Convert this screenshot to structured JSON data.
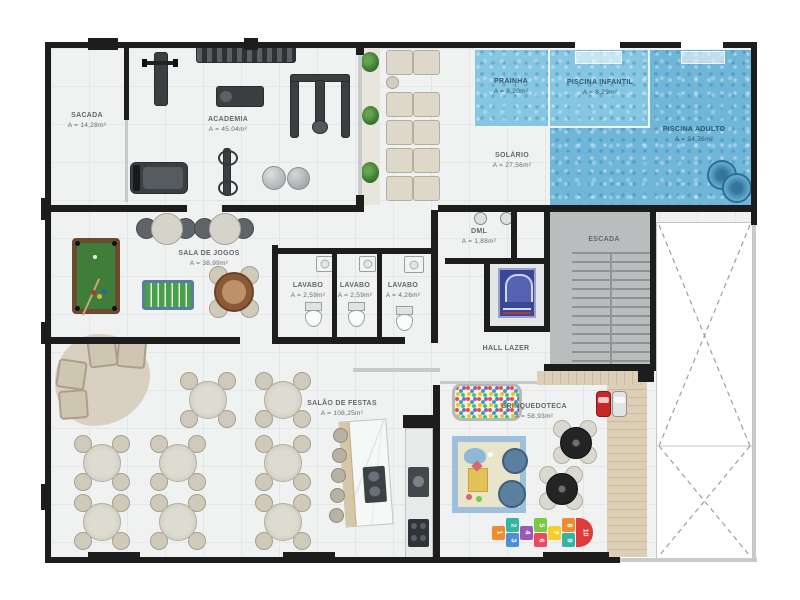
{
  "rooms": {
    "sacada": {
      "name": "SACADA",
      "area": "A = 14,28m²"
    },
    "academia": {
      "name": "ACADEMIA",
      "area": "A = 45,04m²"
    },
    "prainha": {
      "name": "PRAINHA",
      "area": "A = 8,20m²"
    },
    "piscina_infantil": {
      "name": "PISCINA INFANTIL",
      "area": "A = 8,29m²"
    },
    "piscina_adulto": {
      "name": "PISCINA ADULTO",
      "area": "A = 34,76m²"
    },
    "solario": {
      "name": "SOLÁRIO",
      "area": "A = 27,56m²"
    },
    "sala_de_jogos": {
      "name": "SALA DE JOGOS",
      "area": "A = 38,99m²"
    },
    "lavabo_1": {
      "name": "LAVABO",
      "area": "A = 2,59m²"
    },
    "lavabo_2": {
      "name": "LAVABO",
      "area": "A = 2,59m²"
    },
    "lavabo_3": {
      "name": "LAVABO",
      "area": "A = 4,26m²"
    },
    "dml": {
      "name": "DML",
      "area": "A = 1,88m²"
    },
    "escada": {
      "name": "ESCADA"
    },
    "hall_lazer": {
      "name": "HALL LAZER"
    },
    "salao_de_festas": {
      "name": "SALÃO DE FESTAS",
      "area": "A = 108,25m²"
    },
    "brinquedoteca": {
      "name": "BRINQUEDOTECA",
      "area": "A = 58,93m²"
    }
  },
  "hopscotch": [
    "1",
    "2",
    "3",
    "4",
    "5",
    "6",
    "7",
    "8",
    "9",
    "10"
  ],
  "colors": {
    "wall": "#1d1d1d",
    "pool_water": "#6fb6d9",
    "pool_water_light": "#85c6e3",
    "pool_table_felt": "#3e7d3a",
    "foosball_field": "#4aa04a",
    "elevator_blue": "#3a4796",
    "wood_deck": "#d8cab0",
    "concrete": "#b9bdbd",
    "floor_tile": "#f0f2f2",
    "hopscotch_palette": [
      "#f08c2e",
      "#35b3a5",
      "#4a90d9",
      "#9b59b6",
      "#7ac943",
      "#e84a5f",
      "#f2cf2e",
      "#f08c2e",
      "#35b3a5",
      "#e03a3a"
    ]
  }
}
